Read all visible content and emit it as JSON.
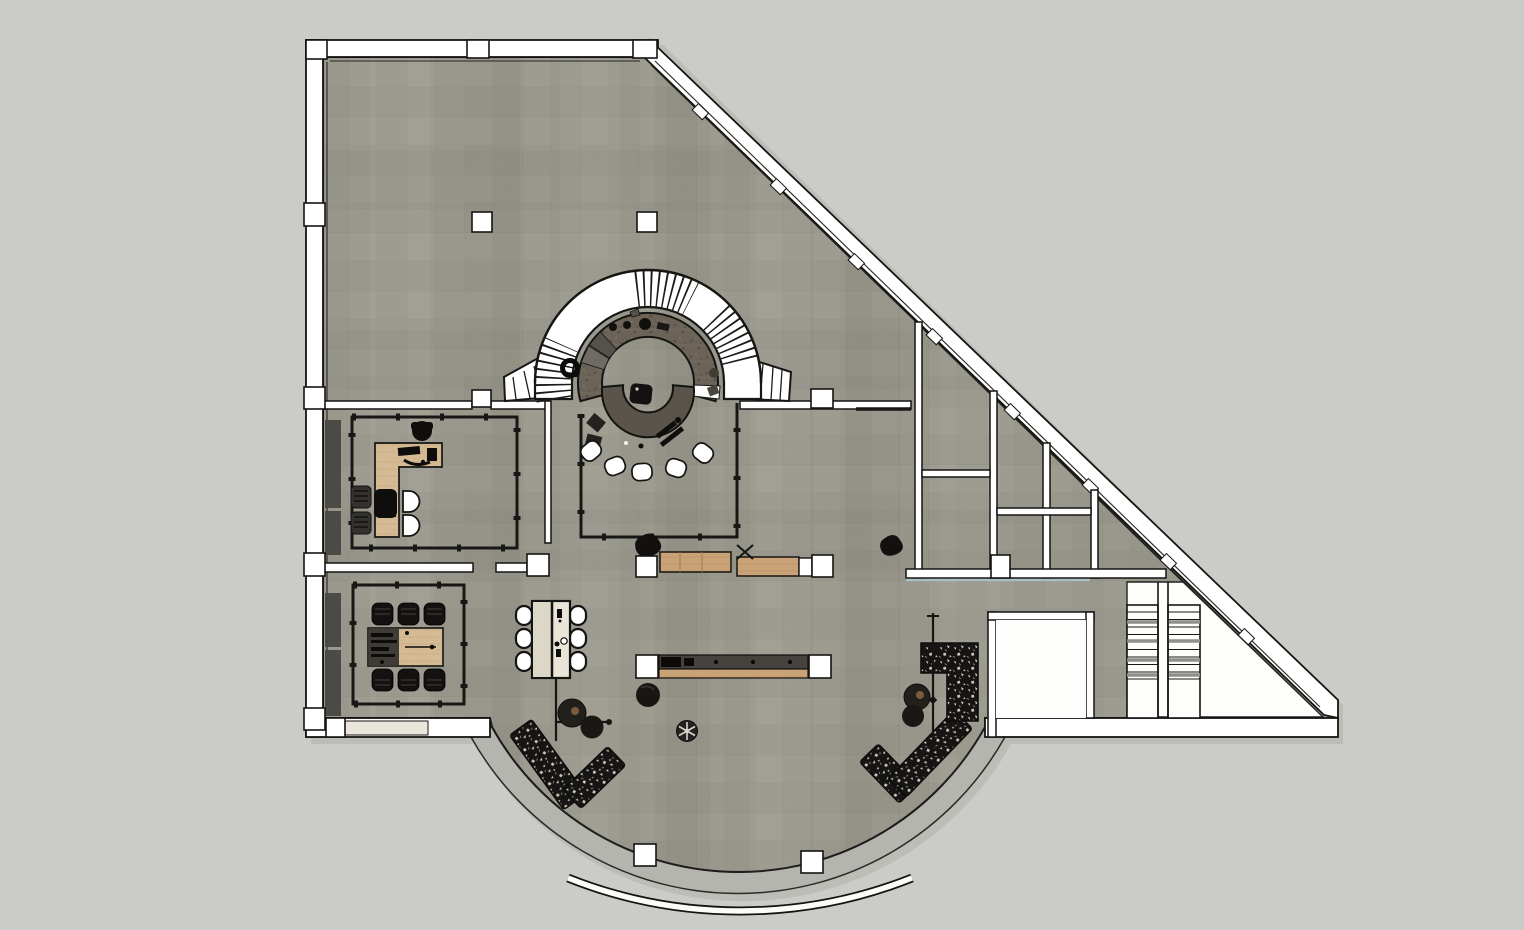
{
  "app": {
    "name": "floor-plan-viewport",
    "view": "top-down architectural plan, SketchUp style"
  },
  "colors": {
    "canvas_bg": "#cbcbc7",
    "shadow": "#b9b9b3",
    "floor_base": "#9a988c",
    "floor_grid": "#73716a",
    "wall_fill": "#ffffff",
    "wall_stroke": "#141412",
    "partition_black": "#171715",
    "glass_teal": "#a9bec5",
    "terrace": "#b5b5af",
    "beige_panel": "#eae6da",
    "storage_dark": "#4c4a46",
    "wood_desk": "#d5bb94",
    "wood_bench": "#c9a377",
    "table_cream": "#e8e4d8",
    "table_cream_dark": "#ddd7c7",
    "counter_ring": "#6b6258",
    "counter_island": "#5a544c",
    "sofa_black": "#161513",
    "sofa_fleck": "#ccc9c0",
    "tread_gray": "#90908a",
    "white_floor": "#fdfdfc",
    "console_top": "#46433e"
  },
  "plan": {
    "areas": [
      {
        "id": "open-plan-area"
      },
      {
        "id": "office-room"
      },
      {
        "id": "meeting-room"
      },
      {
        "id": "bar-room"
      },
      {
        "id": "spiral-stair"
      },
      {
        "id": "service-rooms",
        "room_count": 8
      },
      {
        "id": "lounge"
      },
      {
        "id": "elevator-room"
      },
      {
        "id": "stair-hall",
        "flights": 2
      },
      {
        "id": "curved-terrace"
      },
      {
        "id": "entrance-canopy"
      }
    ],
    "furniture": {
      "bar_stools": 5,
      "dining_chairs": 6,
      "meeting_chairs": 6,
      "office_guest_chairs": 2,
      "office_side_stools": 2,
      "sofas": 3,
      "coffee_tables": 4,
      "poufs": 1,
      "ceiling_fans": 1,
      "floor_lamps": 2,
      "columns": 17,
      "desks": 1,
      "benches": 3
    }
  }
}
